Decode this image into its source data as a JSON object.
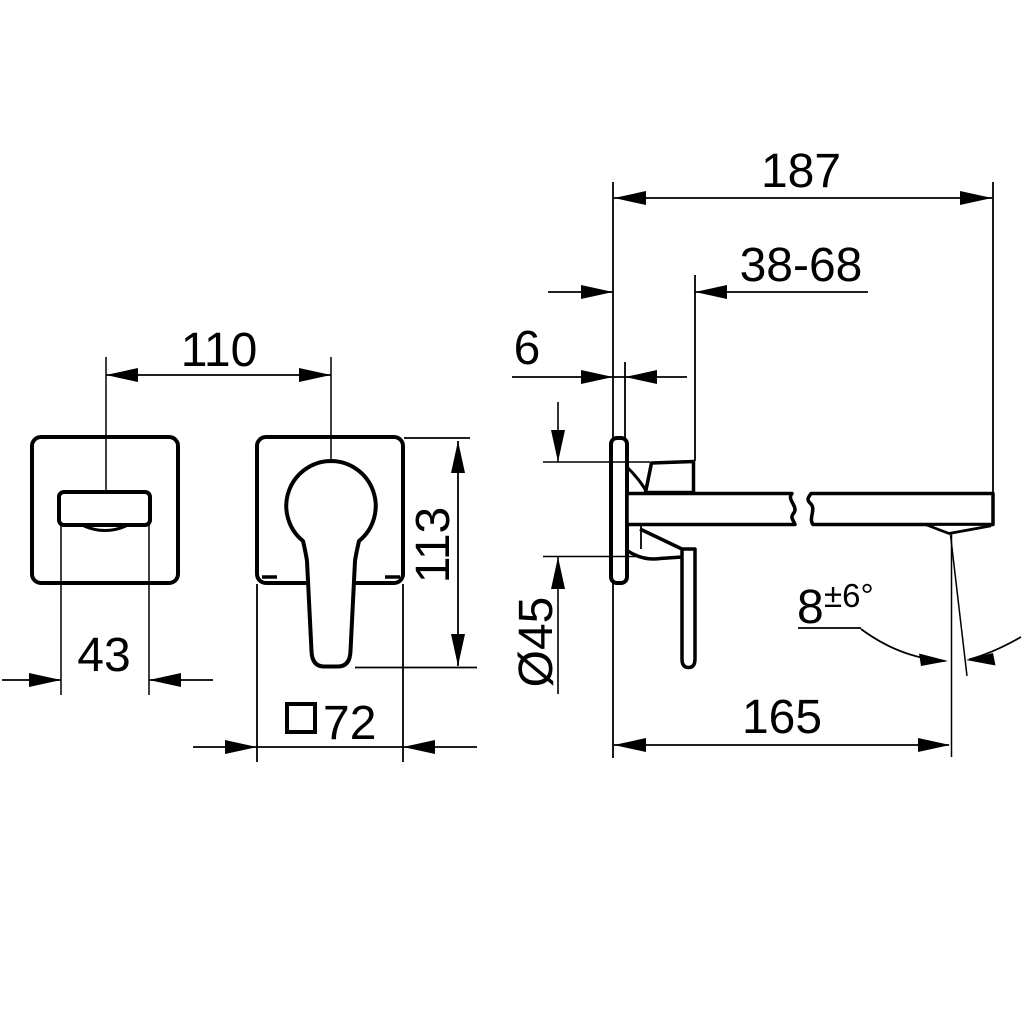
{
  "drawing": {
    "type": "technical dimension drawing",
    "subject": "wall-mounted single-lever basin mixer, front views and side view",
    "units": "mm (implied)",
    "colors": {
      "line": "#000000",
      "background": "#ffffff"
    },
    "labels": {
      "total_depth": "187",
      "adjust_range": "38-68",
      "plate_thickness": "6",
      "center_distance": "110",
      "spout_width": "43",
      "overall_height": "113",
      "plate_square": "72",
      "plate_square_symbol": "□",
      "connection_diameter": "Ø45",
      "spray_angle": "8",
      "spray_angle_tolerance": "±6°",
      "spout_reach": "165"
    }
  }
}
